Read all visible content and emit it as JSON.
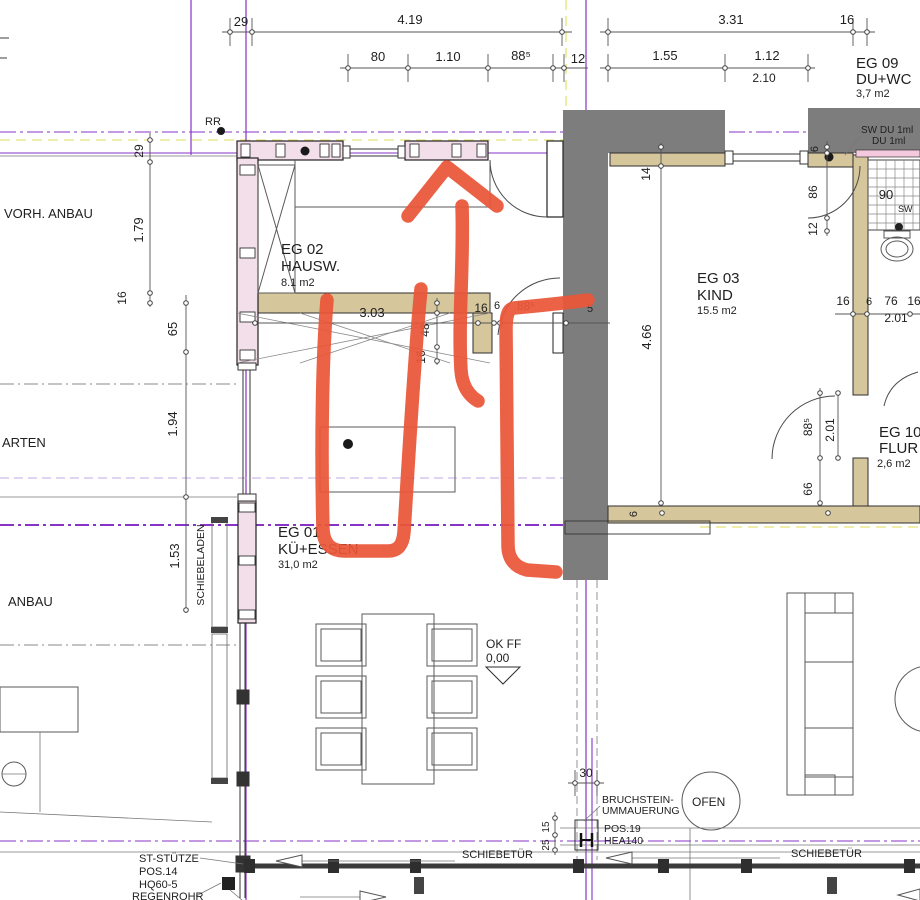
{
  "title": "Grundriss Erdgeschoss (Ausschnitt) mit roter Markierung",
  "palette": {
    "wall_dark": "#7d7d7d",
    "wall_tan": "#d6c69c",
    "wall_pink": "#f3dfe9",
    "axis_purple": "#8633c6",
    "axis_lavender": "#c2a9e6",
    "axis_yellow": "#e9e98c",
    "hatch_brown": "#a8895e",
    "band_fill": "#d9c49c",
    "marker_red": "#ea5638"
  },
  "texts": {
    "rooms": [
      {
        "n": "room-eg02-id",
        "t": "EG 02",
        "x": 281,
        "y": 254,
        "s": 15
      },
      {
        "n": "room-eg02-name",
        "t": "HAUSW.",
        "x": 281,
        "y": 271,
        "s": 15
      },
      {
        "n": "room-eg02-area",
        "t": "8.1 m2",
        "x": 281,
        "y": 286,
        "s": 11
      },
      {
        "n": "room-eg03-id",
        "t": "EG 03",
        "x": 697,
        "y": 283,
        "s": 15
      },
      {
        "n": "room-eg03-name",
        "t": "KIND",
        "x": 697,
        "y": 300,
        "s": 15
      },
      {
        "n": "room-eg03-area",
        "t": "15.5 m2",
        "x": 697,
        "y": 314,
        "s": 11
      },
      {
        "n": "room-eg09-id",
        "t": "EG 09",
        "x": 856,
        "y": 68,
        "s": 15
      },
      {
        "n": "room-eg09-name",
        "t": "DU+WC",
        "x": 856,
        "y": 84,
        "s": 15
      },
      {
        "n": "room-eg09-area",
        "t": "3,7 m2",
        "x": 856,
        "y": 97,
        "s": 11
      },
      {
        "n": "room-eg10-id",
        "t": "EG 10",
        "x": 879,
        "y": 437,
        "s": 15
      },
      {
        "n": "room-eg10-name",
        "t": "FLUR",
        "x": 879,
        "y": 453,
        "s": 15
      },
      {
        "n": "room-eg10-area",
        "t": "2,6 m2",
        "x": 877,
        "y": 467,
        "s": 11
      },
      {
        "n": "room-eg01-id",
        "t": "EG 01",
        "x": 278,
        "y": 537,
        "s": 15
      },
      {
        "n": "room-eg01-name",
        "t": "KÜ+ESSEN",
        "x": 278,
        "y": 554,
        "s": 15
      },
      {
        "n": "room-eg01-area",
        "t": "31,0 m2",
        "x": 278,
        "y": 568,
        "s": 11
      }
    ],
    "dims_top": [
      {
        "n": "dim-29-top",
        "t": "29",
        "x": 241,
        "y": 26,
        "s": 13,
        "a": "middle"
      },
      {
        "n": "dim-419",
        "t": "4.19",
        "x": 410,
        "y": 24,
        "s": 13,
        "a": "middle"
      },
      {
        "n": "dim-80",
        "t": "80",
        "x": 378,
        "y": 61,
        "s": 13,
        "a": "middle"
      },
      {
        "n": "dim-110",
        "t": "1.10",
        "x": 448,
        "y": 61,
        "s": 13,
        "a": "middle"
      },
      {
        "n": "dim-885-top",
        "t": "88⁵",
        "x": 521,
        "y": 60,
        "s": 13,
        "a": "middle"
      },
      {
        "n": "dim-12-top",
        "t": "12",
        "x": 578,
        "y": 63,
        "s": 13,
        "a": "middle"
      },
      {
        "n": "dim-331",
        "t": "3.31",
        "x": 731,
        "y": 24,
        "s": 13,
        "a": "middle"
      },
      {
        "n": "dim-16-top",
        "t": "16",
        "x": 847,
        "y": 24,
        "s": 13,
        "a": "middle"
      },
      {
        "n": "dim-155",
        "t": "1.55",
        "x": 665,
        "y": 60,
        "s": 13,
        "a": "middle"
      },
      {
        "n": "dim-112",
        "t": "1.12",
        "x": 767,
        "y": 60,
        "s": 13,
        "a": "middle"
      },
      {
        "n": "dim-210",
        "t": "2.10",
        "x": 764,
        "y": 82,
        "s": 12,
        "a": "middle"
      }
    ],
    "dims_left": [
      {
        "n": "dim-29-left",
        "t": "29",
        "x": 143,
        "y": 151,
        "s": 12,
        "r": -90,
        "a": "middle"
      },
      {
        "n": "dim-179",
        "t": "1.79",
        "x": 143,
        "y": 230,
        "s": 13,
        "r": -90,
        "a": "middle"
      },
      {
        "n": "dim-16-left",
        "t": "16",
        "x": 126,
        "y": 298,
        "s": 12,
        "r": -90,
        "a": "middle"
      },
      {
        "n": "dim-65",
        "t": "65",
        "x": 177,
        "y": 329,
        "s": 13,
        "r": -90,
        "a": "middle"
      },
      {
        "n": "dim-194",
        "t": "1.94",
        "x": 177,
        "y": 424,
        "s": 13,
        "r": -90,
        "a": "middle"
      },
      {
        "n": "dim-153",
        "t": "1.53",
        "x": 179,
        "y": 556,
        "s": 13,
        "r": -90,
        "a": "middle"
      }
    ],
    "dims_interior": [
      {
        "n": "dim-303",
        "t": "3.03",
        "x": 372,
        "y": 317,
        "s": 13,
        "a": "middle"
      },
      {
        "n": "dim-16-door",
        "t": "16",
        "x": 481,
        "y": 312,
        "s": 12,
        "a": "middle"
      },
      {
        "n": "dim-6-door",
        "t": "6",
        "x": 497,
        "y": 309,
        "s": 11,
        "a": "middle"
      },
      {
        "n": "dim-885-door",
        "t": "88⁵",
        "x": 526,
        "y": 310,
        "s": 12,
        "a": "middle"
      },
      {
        "n": "dim-5-door",
        "t": "5",
        "x": 590,
        "y": 312,
        "s": 11,
        "a": "middle"
      },
      {
        "n": "dim-48",
        "t": "48",
        "x": 429,
        "y": 330,
        "s": 12,
        "r": -90,
        "a": "middle"
      },
      {
        "n": "dim-16-mid",
        "t": "16",
        "x": 425,
        "y": 357,
        "s": 12,
        "r": -90,
        "a": "middle"
      },
      {
        "n": "dim-14",
        "t": "14",
        "x": 650,
        "y": 174,
        "s": 12,
        "r": -90,
        "a": "middle"
      },
      {
        "n": "dim-466",
        "t": "4.66",
        "x": 651,
        "y": 337,
        "s": 13,
        "r": -90,
        "a": "middle"
      },
      {
        "n": "dim-6-wall",
        "t": "6",
        "x": 637,
        "y": 514,
        "s": 11,
        "r": -90,
        "a": "middle"
      }
    ],
    "dims_right": [
      {
        "n": "dim-6-bath",
        "t": "6",
        "x": 818,
        "y": 149,
        "s": 11,
        "r": -90,
        "a": "middle"
      },
      {
        "n": "dim-86",
        "t": "86",
        "x": 817,
        "y": 192,
        "s": 12,
        "r": -90,
        "a": "middle"
      },
      {
        "n": "dim-12-bath",
        "t": "12",
        "x": 817,
        "y": 229,
        "s": 12,
        "r": -90,
        "a": "middle"
      },
      {
        "n": "dim-16-r1",
        "t": "16",
        "x": 843,
        "y": 305,
        "s": 12,
        "a": "middle"
      },
      {
        "n": "dim-6-r",
        "t": "6",
        "x": 869,
        "y": 305,
        "s": 11,
        "a": "middle"
      },
      {
        "n": "dim-76",
        "t": "76",
        "x": 891,
        "y": 305,
        "s": 12,
        "a": "middle"
      },
      {
        "n": "dim-16-r2",
        "t": "16",
        "x": 914,
        "y": 305,
        "s": 12,
        "a": "middle"
      },
      {
        "n": "dim-201-r",
        "t": "2.01",
        "x": 896,
        "y": 322,
        "s": 12,
        "a": "middle"
      },
      {
        "n": "dim-885-flur",
        "t": "88⁵",
        "x": 812,
        "y": 427,
        "s": 12,
        "r": -90,
        "a": "middle"
      },
      {
        "n": "dim-201-flur",
        "t": "2.01",
        "x": 834,
        "y": 430,
        "s": 12,
        "r": -90,
        "a": "middle"
      },
      {
        "n": "dim-66",
        "t": "66",
        "x": 812,
        "y": 489,
        "s": 12,
        "r": -90,
        "a": "middle"
      },
      {
        "n": "dim-90-shower",
        "t": "90",
        "x": 886,
        "y": 199,
        "s": 13,
        "a": "middle"
      },
      {
        "n": "label-sw-small",
        "t": "SW",
        "x": 898,
        "y": 212,
        "s": 9
      }
    ],
    "dims_bottom": [
      {
        "n": "dim-30",
        "t": "30",
        "x": 586,
        "y": 777,
        "s": 12,
        "a": "middle"
      },
      {
        "n": "dim-15",
        "t": "15",
        "x": 549,
        "y": 827,
        "s": 10,
        "r": -90,
        "a": "middle"
      },
      {
        "n": "dim-25",
        "t": "25",
        "x": 549,
        "y": 845,
        "s": 10,
        "r": -90,
        "a": "middle"
      }
    ],
    "site_labels": [
      {
        "n": "label-rr",
        "t": "RR",
        "x": 205,
        "y": 125,
        "s": 11,
        "c": "#3a3a3a"
      },
      {
        "n": "label-vorh-anbau",
        "t": "VORH. ANBAU",
        "x": 4,
        "y": 218,
        "s": 13,
        "c": "#3a3a3a"
      },
      {
        "n": "label-garten",
        "t": "ARTEN",
        "x": 2,
        "y": 447,
        "s": 13,
        "c": "#3a3a3a"
      },
      {
        "n": "label-anbau",
        "t": "ANBAU",
        "x": 8,
        "y": 606,
        "s": 13,
        "c": "#3a3a3a"
      },
      {
        "n": "label-schiebeladen",
        "t": "SCHIEBELADEN",
        "x": 204,
        "y": 565,
        "s": 10.5,
        "r": -90,
        "a": "middle",
        "c": "#3a3a3a"
      }
    ],
    "equipment_labels": [
      {
        "n": "label-sw-du",
        "t": "SW DU 1ml",
        "x": 861,
        "y": 133,
        "s": 10,
        "c": "#3a3a3a"
      },
      {
        "n": "label-du",
        "t": "DU 1ml",
        "x": 872,
        "y": 144,
        "s": 10,
        "c": "#3a3a3a"
      },
      {
        "n": "label-ok-ff",
        "t": "OK FF",
        "x": 486,
        "y": 648,
        "s": 12,
        "c": "#2e2e2e"
      },
      {
        "n": "label-level",
        "t": "0,00",
        "x": 486,
        "y": 662,
        "s": 12,
        "c": "#2e2e2e"
      },
      {
        "n": "label-ofen",
        "t": "OFEN",
        "x": 692,
        "y": 806,
        "s": 12,
        "c": "#3a3a3a"
      },
      {
        "n": "label-schiebetuer-1",
        "t": "SCHIEBETÜR",
        "x": 462,
        "y": 858,
        "s": 11,
        "c": "#3a3a3a"
      },
      {
        "n": "label-schiebetuer-2",
        "t": "SCHIEBETÜR",
        "x": 791,
        "y": 857,
        "s": 11,
        "c": "#3a3a3a"
      },
      {
        "n": "label-st-stuetze",
        "t": "ST-STÜTZE",
        "x": 139,
        "y": 862,
        "s": 11,
        "c": "#3a3a3a"
      },
      {
        "n": "label-pos14",
        "t": "POS.14",
        "x": 139,
        "y": 875,
        "s": 11,
        "c": "#3a3a3a"
      },
      {
        "n": "label-hq60",
        "t": "HQ60-5",
        "x": 139,
        "y": 888,
        "s": 11,
        "c": "#3a3a3a"
      },
      {
        "n": "label-regenrohr",
        "t": "REGENROHR",
        "x": 132,
        "y": 900,
        "s": 11,
        "c": "#3a3a3a"
      },
      {
        "n": "label-bruchstein-1",
        "t": "BRUCHSTEIN-",
        "x": 602,
        "y": 803,
        "s": 10.5,
        "c": "#3a3a3a"
      },
      {
        "n": "label-bruchstein-2",
        "t": "UMMAUERUNG",
        "x": 602,
        "y": 814,
        "s": 10.5,
        "c": "#3a3a3a"
      },
      {
        "n": "label-pos19",
        "t": "POS.19",
        "x": 604,
        "y": 832,
        "s": 10.5,
        "c": "#3a3a3a"
      },
      {
        "n": "label-hea140",
        "t": "HEA140",
        "x": 604,
        "y": 844,
        "s": 10.5,
        "c": "#3a3a3a"
      }
    ]
  }
}
